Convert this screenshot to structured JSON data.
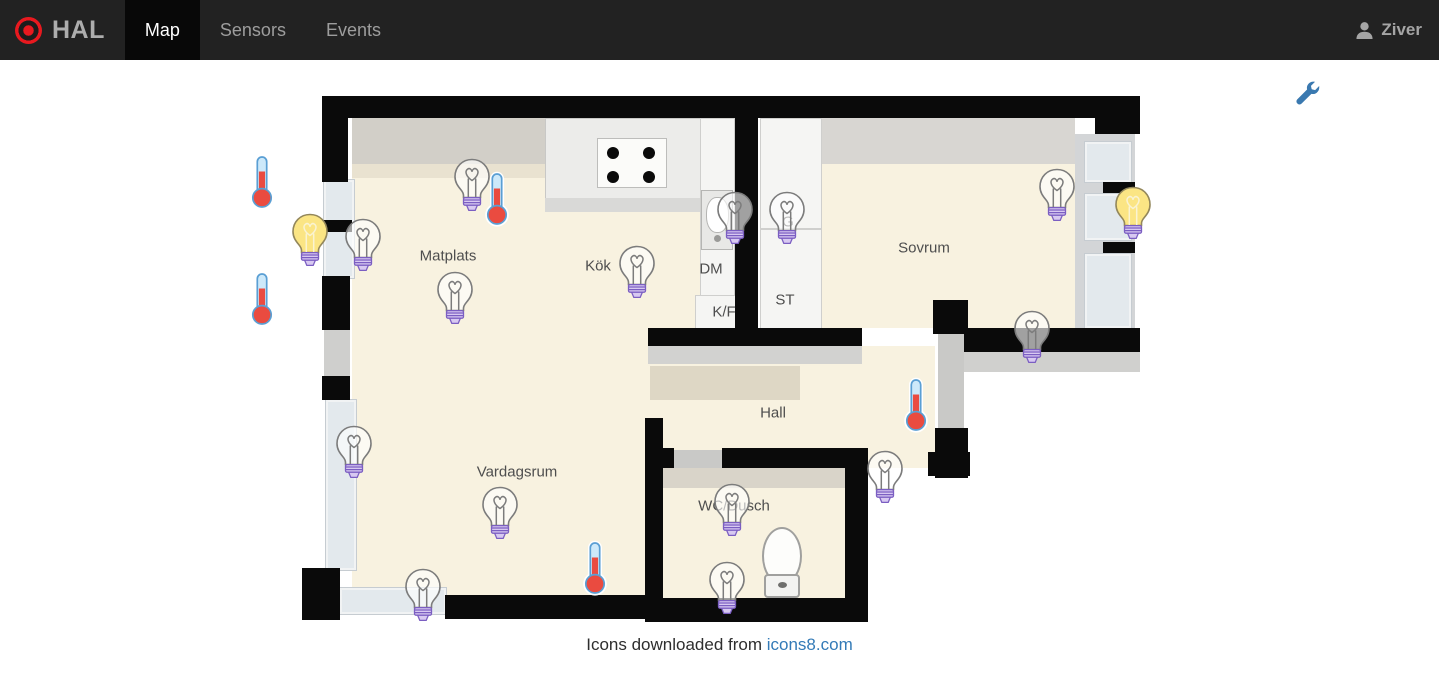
{
  "header": {
    "brand": "HAL",
    "nav_items": [
      {
        "id": "map",
        "label": "Map",
        "active": true
      },
      {
        "id": "sensors",
        "label": "Sensors",
        "active": false
      },
      {
        "id": "events",
        "label": "Events",
        "active": false
      }
    ],
    "user_name": "Ziver"
  },
  "map": {
    "room_labels": [
      {
        "id": "matplats",
        "text": "Matplats",
        "x": 448,
        "y": 196
      },
      {
        "id": "kok",
        "text": "Kök",
        "x": 598,
        "y": 206
      },
      {
        "id": "dm",
        "text": "DM",
        "x": 711,
        "y": 209
      },
      {
        "id": "kf",
        "text": "K/F",
        "x": 724,
        "y": 252
      },
      {
        "id": "st",
        "text": "ST",
        "x": 785,
        "y": 240
      },
      {
        "id": "g",
        "text": "G",
        "x": 788,
        "y": 162
      },
      {
        "id": "sovrum",
        "text": "Sovrum",
        "x": 924,
        "y": 188
      },
      {
        "id": "hall",
        "text": "Hall",
        "x": 773,
        "y": 353
      },
      {
        "id": "vardagsrum",
        "text": "Vardagsrum",
        "x": 517,
        "y": 412
      },
      {
        "id": "wc-dusch",
        "text": "WC/Dusch",
        "x": 734,
        "y": 446
      }
    ],
    "devices": [
      {
        "id": "bulb-matplats-wall",
        "type": "bulb",
        "state": "off",
        "x": 472,
        "y": 125
      },
      {
        "id": "bulb-left-window",
        "type": "bulb",
        "state": "off",
        "x": 363,
        "y": 185
      },
      {
        "id": "bulb-matplats",
        "type": "bulb",
        "state": "off",
        "x": 455,
        "y": 238
      },
      {
        "id": "bulb-kok",
        "type": "bulb",
        "state": "off",
        "x": 637,
        "y": 212
      },
      {
        "id": "bulb-dm",
        "type": "bulb",
        "state": "off",
        "x": 735,
        "y": 158
      },
      {
        "id": "bulb-garderob",
        "type": "bulb",
        "state": "off",
        "x": 787,
        "y": 158
      },
      {
        "id": "bulb-sovrum-ne",
        "type": "bulb",
        "state": "off",
        "x": 1057,
        "y": 135
      },
      {
        "id": "bulb-sovrum-s",
        "type": "bulb",
        "state": "off",
        "x": 1032,
        "y": 277
      },
      {
        "id": "bulb-vardagsrum-window",
        "type": "bulb",
        "state": "off",
        "x": 354,
        "y": 392
      },
      {
        "id": "bulb-vardagsrum",
        "type": "bulb",
        "state": "off",
        "x": 500,
        "y": 453
      },
      {
        "id": "bulb-vardagsrum-s",
        "type": "bulb",
        "state": "off",
        "x": 423,
        "y": 535
      },
      {
        "id": "bulb-wc",
        "type": "bulb",
        "state": "off",
        "x": 732,
        "y": 450
      },
      {
        "id": "bulb-wc-s",
        "type": "bulb",
        "state": "off",
        "x": 727,
        "y": 528
      },
      {
        "id": "bulb-hall-se",
        "type": "bulb",
        "state": "off",
        "x": 885,
        "y": 417
      },
      {
        "id": "bulb-left-window-on",
        "type": "bulb",
        "state": "on",
        "x": 310,
        "y": 180
      },
      {
        "id": "bulb-sovrum-window-on",
        "type": "bulb",
        "state": "on",
        "x": 1133,
        "y": 153
      },
      {
        "id": "thermo-outdoor-n",
        "type": "thermometer",
        "state": "warm",
        "x": 262,
        "y": 122
      },
      {
        "id": "thermo-outdoor-s",
        "type": "thermometer",
        "state": "warm",
        "x": 262,
        "y": 239
      },
      {
        "id": "thermo-matplats",
        "type": "thermometer",
        "state": "warm",
        "x": 497,
        "y": 139
      },
      {
        "id": "thermo-hall-door",
        "type": "thermometer",
        "state": "warm",
        "x": 916,
        "y": 345
      },
      {
        "id": "thermo-vardagsrum",
        "type": "thermometer",
        "state": "warm",
        "x": 595,
        "y": 508
      }
    ]
  },
  "footer": {
    "text_prefix": "Icons downloaded from ",
    "link_text": "icons8.com"
  },
  "icons": {
    "hal-logo-icon": "red bullseye",
    "user-icon": "person silhouette",
    "wrench-icon": "blue wrench",
    "bulb-icon": "light bulb with purple base",
    "thermometer-icon": "thermometer with red mercury"
  },
  "colors": {
    "header_bg": "#222222",
    "header_active_bg": "#080808",
    "nav_text": "#9d9d9d",
    "logo_red": "#e8191f",
    "link_blue": "#337ab7",
    "wrench_blue": "#3a79b0",
    "bulb_on_yellow": "#fbe584",
    "bulb_base_purple": "#7b5ec2",
    "thermo_red": "#ea4b40",
    "thermo_blue": "#5a9fd4",
    "floor_beige": "#f8f2e0",
    "wall_black": "#0a0a0a"
  }
}
